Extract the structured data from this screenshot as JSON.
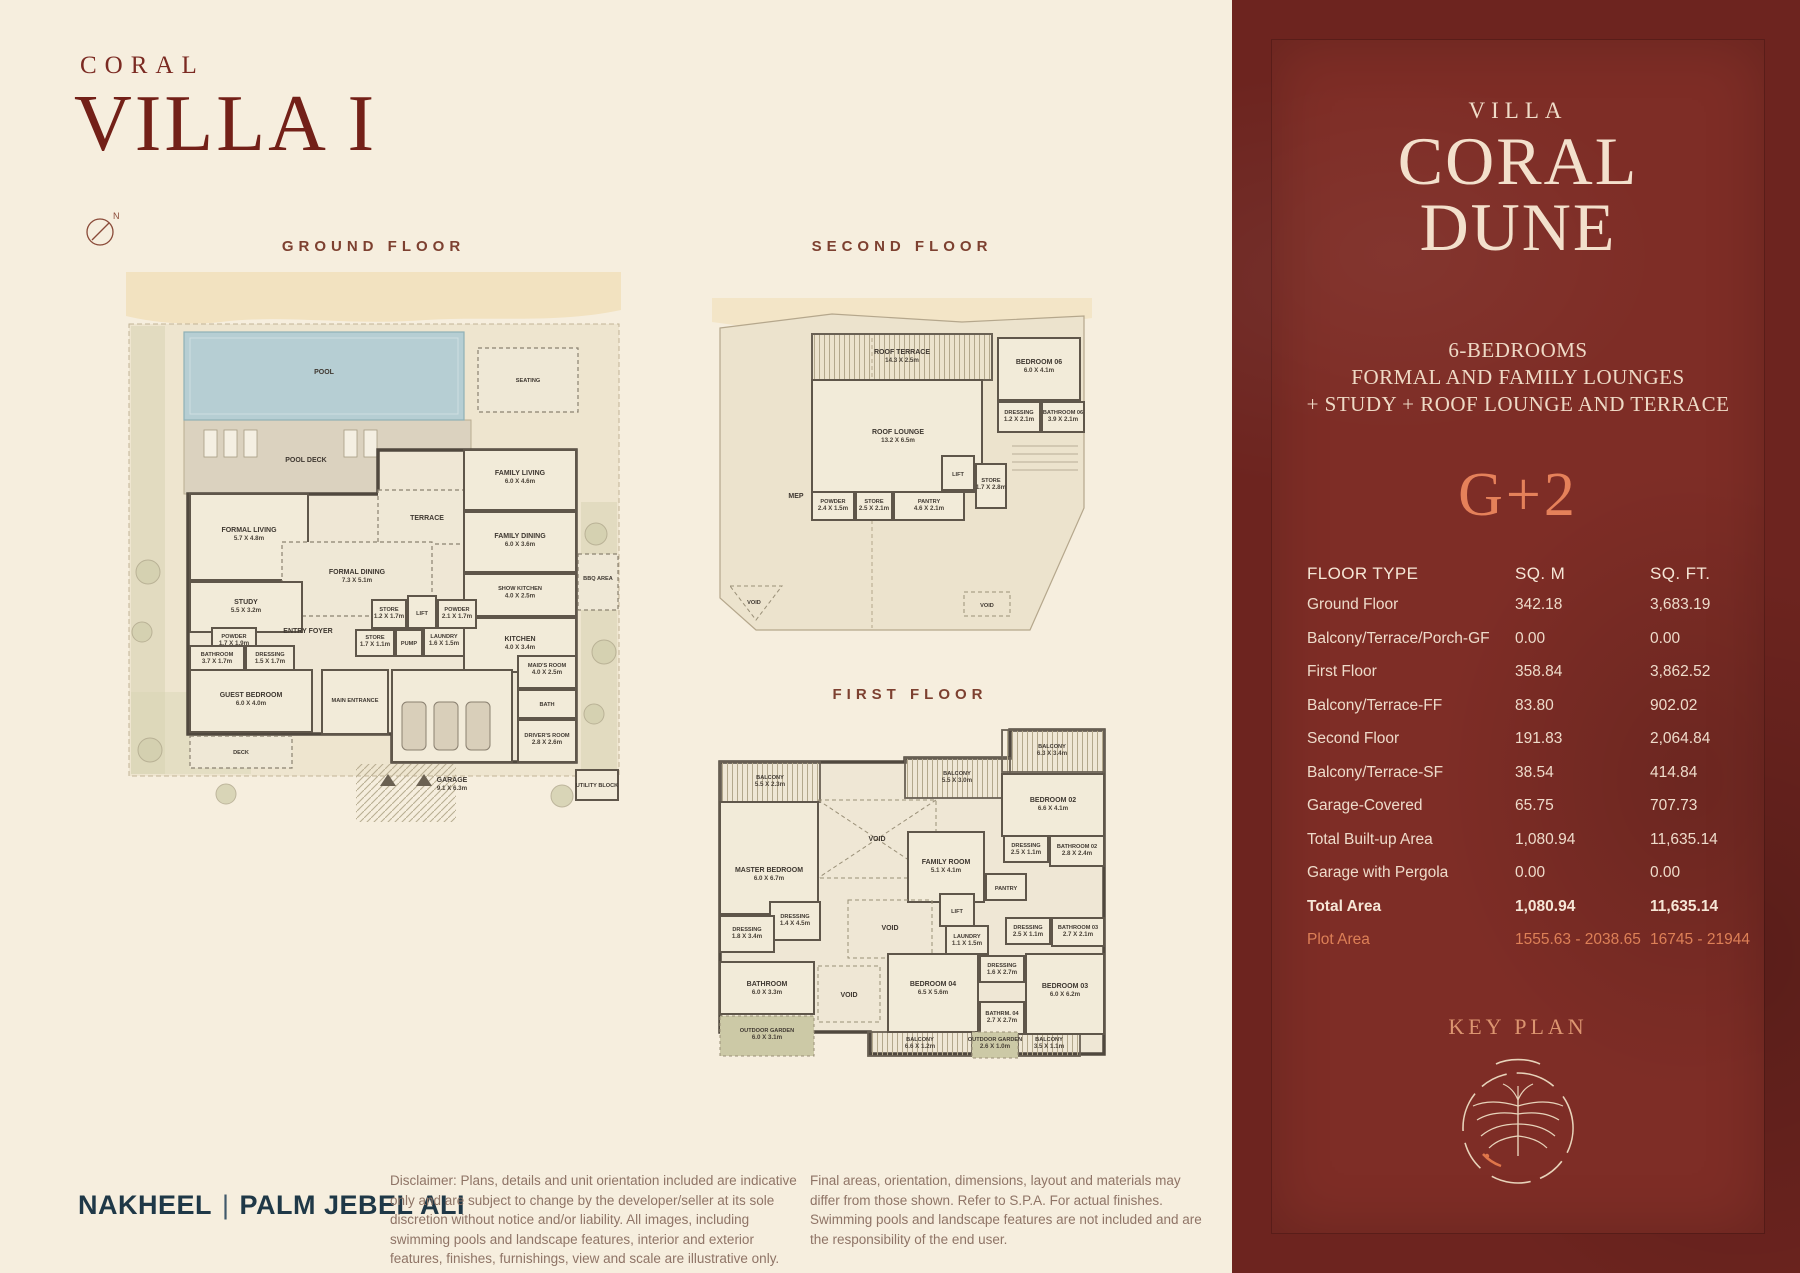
{
  "header": {
    "brand": "CORAL",
    "title": "VILLA I",
    "compass_n": "N"
  },
  "floors": {
    "ground": {
      "title": "GROUND FLOOR",
      "rooms": [
        {
          "name": "POOL",
          "dims": ""
        },
        {
          "name": "POOL DECK",
          "dims": ""
        },
        {
          "name": "SEATING",
          "dims": ""
        },
        {
          "name": "FAMILY LIVING",
          "dims": "6.0 X 4.6m"
        },
        {
          "name": "FORMAL LIVING",
          "dims": "5.7 X 4.8m"
        },
        {
          "name": "TERRACE",
          "dims": ""
        },
        {
          "name": "FAMILY DINING",
          "dims": "6.0 X 3.6m"
        },
        {
          "name": "FORMAL DINING",
          "dims": "7.3 X 5.1m"
        },
        {
          "name": "SHOW KITCHEN",
          "dims": "4.0 X 2.5m"
        },
        {
          "name": "STUDY",
          "dims": "5.5 X 3.2m"
        },
        {
          "name": "ENTRY FOYER",
          "dims": ""
        },
        {
          "name": "STORE",
          "dims": "1.2 X 1.7m"
        },
        {
          "name": "LIFT",
          "dims": ""
        },
        {
          "name": "POWDER",
          "dims": "2.1 X 1.7m"
        },
        {
          "name": "STORE",
          "dims": "1.7 X 1.1m"
        },
        {
          "name": "PUMP",
          "dims": ""
        },
        {
          "name": "LAUNDRY",
          "dims": "1.6 X 1.5m"
        },
        {
          "name": "KITCHEN",
          "dims": "4.0 X 3.4m"
        },
        {
          "name": "POWDER",
          "dims": "1.7 X 1.9m"
        },
        {
          "name": "BATHROOM",
          "dims": "3.7 X 1.7m"
        },
        {
          "name": "DRESSING",
          "dims": "1.5 X 1.7m"
        },
        {
          "name": "GUEST BEDROOM",
          "dims": "6.0 X 4.0m"
        },
        {
          "name": "MAIN ENTRANCE",
          "dims": ""
        },
        {
          "name": "GARAGE",
          "dims": "9.1 X 6.3m"
        },
        {
          "name": "MAID'S ROOM",
          "dims": "4.0 X 2.5m"
        },
        {
          "name": "BATH",
          "dims": ""
        },
        {
          "name": "DRIVER'S ROOM",
          "dims": "2.8 X 2.6m"
        },
        {
          "name": "BBQ AREA",
          "dims": ""
        },
        {
          "name": "DECK",
          "dims": ""
        },
        {
          "name": "UTILITY BLOCK",
          "dims": ""
        }
      ]
    },
    "second": {
      "title": "SECOND FLOOR",
      "rooms": [
        {
          "name": "ROOF TERRACE",
          "dims": "14.3 X 2.5m"
        },
        {
          "name": "BEDROOM 06",
          "dims": "6.0 X 4.1m"
        },
        {
          "name": "DRESSING",
          "dims": "1.2 X 2.1m"
        },
        {
          "name": "BATHROOM 06",
          "dims": "3.9 X 2.1m"
        },
        {
          "name": "ROOF LOUNGE",
          "dims": "13.2 X 6.5m"
        },
        {
          "name": "LIFT",
          "dims": ""
        },
        {
          "name": "STORE",
          "dims": "1.7 X 2.8m"
        },
        {
          "name": "POWDER",
          "dims": "2.4 X 1.5m"
        },
        {
          "name": "STORE",
          "dims": "2.5 X 2.1m"
        },
        {
          "name": "PANTRY",
          "dims": "4.6 X 2.1m"
        },
        {
          "name": "MEP",
          "dims": ""
        },
        {
          "name": "VOID",
          "dims": ""
        },
        {
          "name": "VOID",
          "dims": ""
        }
      ]
    },
    "first": {
      "title": "FIRST FLOOR",
      "rooms": [
        {
          "name": "BALCONY",
          "dims": "5.5 X 2.3m"
        },
        {
          "name": "BALCONY",
          "dims": "5.5 X 3.0m"
        },
        {
          "name": "BALCONY",
          "dims": "6.3 X 3.4m"
        },
        {
          "name": "BEDROOM 02",
          "dims": "6.6 X 4.1m"
        },
        {
          "name": "VOID",
          "dims": ""
        },
        {
          "name": "MASTER BEDROOM",
          "dims": "6.0 X 6.7m"
        },
        {
          "name": "FAMILY ROOM",
          "dims": "5.1 X 4.1m"
        },
        {
          "name": "PANTRY",
          "dims": ""
        },
        {
          "name": "DRESSING",
          "dims": "2.5 X 1.1m"
        },
        {
          "name": "BATHROOM 02",
          "dims": "2.8 X 2.4m"
        },
        {
          "name": "LIFT",
          "dims": ""
        },
        {
          "name": "DRESSING",
          "dims": "1.4 X 4.5m"
        },
        {
          "name": "VOID",
          "dims": ""
        },
        {
          "name": "LAUNDRY",
          "dims": "1.1 X 1.5m"
        },
        {
          "name": "DRESSING",
          "dims": "2.5 X 1.1m"
        },
        {
          "name": "BATHROOM 03",
          "dims": "2.7 X 2.1m"
        },
        {
          "name": "DRESSING",
          "dims": "1.8 X 3.4m"
        },
        {
          "name": "BATHROOM",
          "dims": "6.0 X 3.3m"
        },
        {
          "name": "VOID",
          "dims": ""
        },
        {
          "name": "OUTDOOR GARDEN",
          "dims": "6.0 X 3.1m"
        },
        {
          "name": "BEDROOM 04",
          "dims": "6.5 X 5.6m"
        },
        {
          "name": "DRESSING",
          "dims": "1.6 X 2.7m"
        },
        {
          "name": "BATHRM. 04",
          "dims": "2.7 X 2.7m"
        },
        {
          "name": "BEDROOM 03",
          "dims": "6.0 X 6.2m"
        },
        {
          "name": "BALCONY",
          "dims": "6.6 X 1.2m"
        },
        {
          "name": "OUTDOOR GARDEN",
          "dims": "2.6 X 1.0m"
        },
        {
          "name": "BALCONY",
          "dims": "3.5 X 1.1m"
        }
      ]
    }
  },
  "panel": {
    "subtitle": "VILLA",
    "title": [
      "CORAL",
      "DUNE"
    ],
    "features": [
      "6-BEDROOMS",
      "FORMAL AND FAMILY LOUNGES",
      "+ STUDY + ROOF LOUNGE AND TERRACE"
    ],
    "config": "G+2",
    "table": {
      "col_floor_type": "FLOOR TYPE",
      "col_sqm": "SQ. M",
      "col_sqft": "SQ. FT.",
      "rows": [
        {
          "label": "Ground Floor",
          "sqm": "342.18",
          "sqft": "3,683.19"
        },
        {
          "label": "Balcony/Terrace/Porch-GF",
          "sqm": "0.00",
          "sqft": "0.00"
        },
        {
          "label": "First Floor",
          "sqm": "358.84",
          "sqft": "3,862.52"
        },
        {
          "label": "Balcony/Terrace-FF",
          "sqm": "83.80",
          "sqft": "902.02"
        },
        {
          "label": "Second Floor",
          "sqm": "191.83",
          "sqft": "2,064.84"
        },
        {
          "label": "Balcony/Terrace-SF",
          "sqm": "38.54",
          "sqft": "414.84"
        },
        {
          "label": "Garage-Covered",
          "sqm": "65.75",
          "sqft": "707.73"
        },
        {
          "label": "Total Built-up Area",
          "sqm": "1,080.94",
          "sqft": "11,635.14"
        },
        {
          "label": "Garage with Pergola",
          "sqm": "0.00",
          "sqft": "0.00"
        },
        {
          "label": "Total Area",
          "sqm": "1,080.94",
          "sqft": "11,635.14"
        },
        {
          "label": "Plot Area",
          "sqm": "1555.63 - 2038.65",
          "sqft": "16745 - 21944"
        }
      ]
    },
    "key_plan_title": "KEY PLAN"
  },
  "footer": {
    "logo_name": "NAKHEEL",
    "logo_divider": "|",
    "logo_area": "PALM JEBEL ALI",
    "disclaimer_left": "Disclaimer: Plans, details and unit orientation included are indicative only and are subject to change by the developer/seller at its sole discretion without notice and/or liability. All images, including swimming pools and landscape features, interior and exterior features, finishes, furnishings, view and scale are illustrative only.",
    "disclaimer_right": "Final areas, orientation, dimensions, layout and materials may differ from those shown. Refer to S.P.A. For actual finishes. Swimming pools and landscape features are not included and are the responsibility of the end user."
  },
  "colors": {
    "page_cream": "#f6eede",
    "maroon": "#732018",
    "panel_red": "#7e2d26",
    "accent_orange": "#e5815a",
    "navy": "#1f3847"
  }
}
